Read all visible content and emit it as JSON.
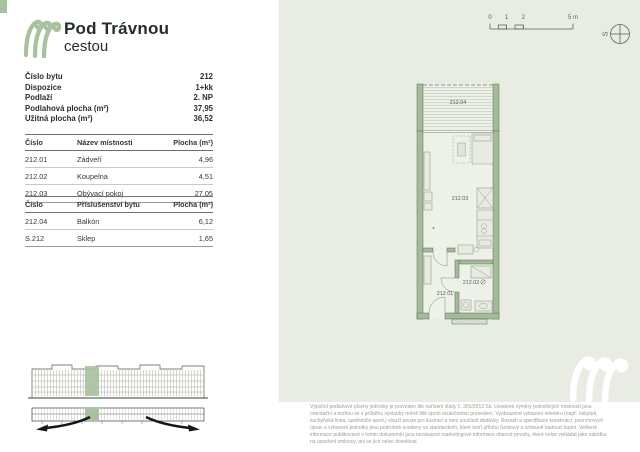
{
  "header": {
    "title_line1": "Pod Trávnou",
    "title_line2": "cestou"
  },
  "info": {
    "rows": [
      {
        "label": "Číslo bytu",
        "value": "212"
      },
      {
        "label": "Dispozice",
        "value": "1+kk"
      },
      {
        "label": "Podlaží",
        "value": "2. NP"
      },
      {
        "label": "Podlahová plocha (m²)",
        "value": "37,95"
      },
      {
        "label": "Užitná plocha (m²)",
        "value": "36,52"
      }
    ]
  },
  "rooms_table": {
    "headers": [
      "Číslo",
      "Název místnosti",
      "Plocha (m²)"
    ],
    "rows": [
      {
        "id": "212.01",
        "name": "Zádveří",
        "area": "4,96"
      },
      {
        "id": "212.02",
        "name": "Koupelna",
        "area": "4,51"
      },
      {
        "id": "212.03",
        "name": "Obývací pokoj",
        "area": "27,05"
      }
    ]
  },
  "accessories_table": {
    "headers": [
      "Číslo",
      "Příslušenství bytu",
      "Plocha (m²)"
    ],
    "rows": [
      {
        "id": "212.04",
        "name": "Balkón",
        "area": "6,12"
      },
      {
        "id": "S.212",
        "name": "Sklep",
        "area": "1,65"
      }
    ]
  },
  "plan": {
    "labels": {
      "balcony": "212.04",
      "living": "212.03",
      "bath": "212.02",
      "hall": "212.01"
    },
    "scalebar": {
      "t0": "0",
      "t1": "1",
      "t2": "2",
      "t5": "5 m"
    },
    "compass": "S"
  },
  "disclaimer": "Výpočet podlahové plochy jednotky je proveden dle nařízení vlády č. 366/2013 Sb. Uvedené výměry jednotlivých místností jsou orientační a mohou se v průběhu výstavby mírně lišit oproti skutečnému provedení. Vyobrazené vybavení interiéru (např. nábytek, kuchyňská linka, spotřebiče apod.) slouží pouze pro ilustraci a není součástí dodávky. Rozsah a specifikace konstrukcí, povrchových úprav a vybavení jednotky jsou podrobně uvedeny ve standardech, které tvoří přílohu Smlouvy o smlouvě budoucí kupní. Veškeré informace publikované v tomto dokumentu jsou nezávazné marketingové informace obecné povahy, které nelze vykládat jako nabídku na uzavření smlouvy, ani se jich nelze dovolávat.",
  "colors": {
    "accent_green": "#a9c29e",
    "panel_bg": "#e9ece3",
    "wall_green": "#a3bb98",
    "text_dark": "#242e27",
    "disclaimer_gray": "#999e96"
  }
}
